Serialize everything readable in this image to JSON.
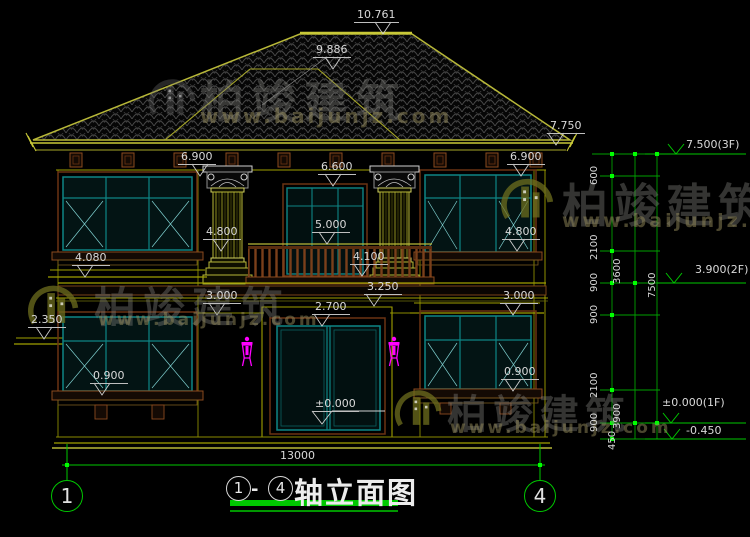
{
  "drawing": {
    "type": "architectural-elevation",
    "sheet_title": "轴立面图",
    "total_width_dim": "13000"
  },
  "labels": {
    "l10761": "10.761",
    "l9886": "9.886",
    "l7750": "7.750",
    "l6900": "6.900",
    "l6600": "6.600",
    "l5000": "5.000",
    "l4800": "4.800",
    "l4100": "4.100",
    "l4080": "4.080",
    "l3250": "3.250",
    "l3000": "3.000",
    "l2700": "2.700",
    "l2350": "2.350",
    "l0900": "0.900",
    "lzero": "±0.000",
    "l13000": "13000"
  },
  "right_panel": {
    "f3": "7.500(3F)",
    "f2": "3.900(2F)",
    "f1": "±0.000(1F)",
    "fm": "-0.450",
    "chain_inner": [
      "600",
      "2100",
      "900",
      "900",
      "2100",
      "900",
      "450"
    ],
    "chain_mid": [
      "3600",
      "3900"
    ],
    "chain_outer": [
      "7500"
    ]
  },
  "axis": {
    "left": "1",
    "right": "4"
  },
  "title": {
    "num_left": "1",
    "dash": "-",
    "num_right": "4",
    "text": "轴立面图"
  },
  "watermark": {
    "brand": "柏竣建筑",
    "url": "www.baijunjz.com"
  },
  "colors": {
    "background": "#000000",
    "dimension_green": "#00c800",
    "bright_green": "#00ff00",
    "building_olive": "#b8b838",
    "window_teal": "#0e8585",
    "wood_brown": "#8a4a1e",
    "lamp_magenta": "#ff00ff",
    "text_gray": "#d9d9d9",
    "tile_line": "#4a4a4a"
  }
}
